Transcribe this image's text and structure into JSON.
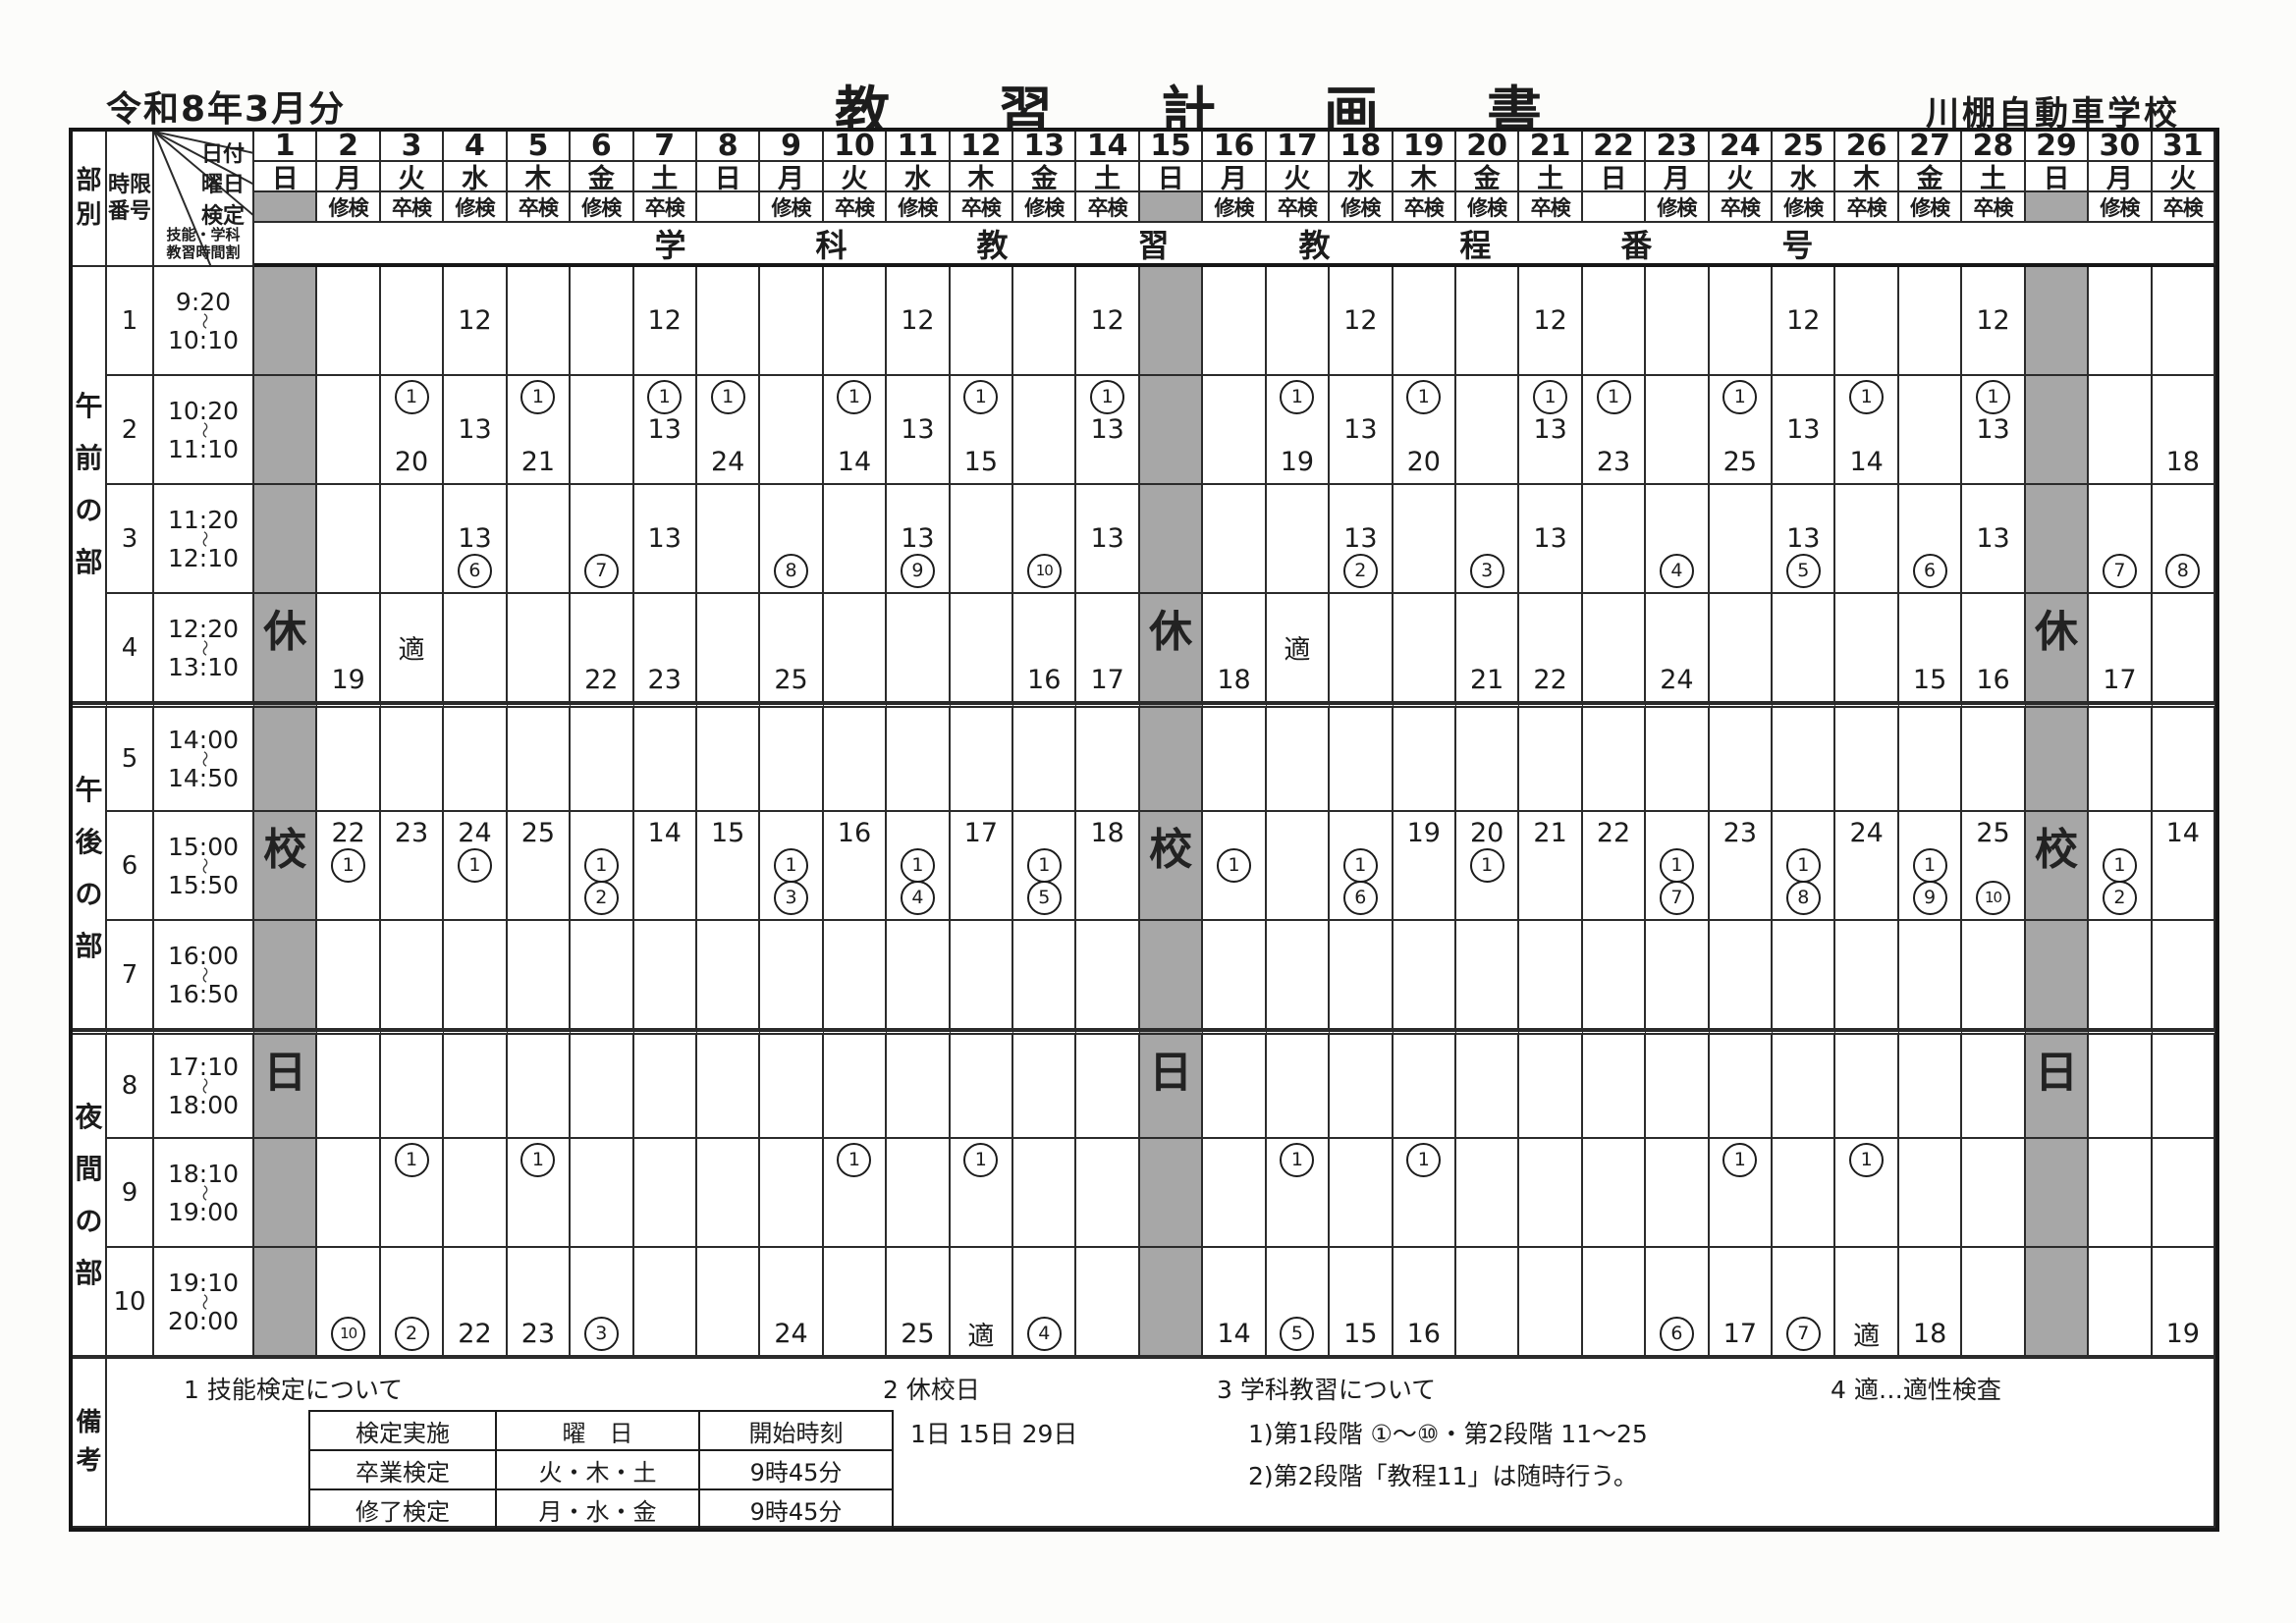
{
  "page": {
    "ink": "#1c1c1c",
    "line": "#2b2b2b",
    "closed_gray": "#a7a7a7",
    "paper": "#fcfcfa"
  },
  "title": {
    "period": "令和8年3月分",
    "main": "教習計画書",
    "school": "川棚自動車学校"
  },
  "corner": {
    "part_label": "部別",
    "period_label_1": "時限",
    "period_label_2": "番号",
    "row_labels": [
      "日付",
      "曜日",
      "検定"
    ],
    "skill_label_1": "技能・学科",
    "skill_label_2": "教習時間割"
  },
  "band_title": "学科教習教程番号",
  "wave": "〜",
  "closed_vertical": "休校日",
  "days": [
    {
      "date": 1,
      "dow": "日",
      "exam": "",
      "closed": true
    },
    {
      "date": 2,
      "dow": "月",
      "exam": "修検",
      "closed": false
    },
    {
      "date": 3,
      "dow": "火",
      "exam": "卒検",
      "closed": false
    },
    {
      "date": 4,
      "dow": "水",
      "exam": "修検",
      "closed": false
    },
    {
      "date": 5,
      "dow": "木",
      "exam": "卒検",
      "closed": false
    },
    {
      "date": 6,
      "dow": "金",
      "exam": "修検",
      "closed": false
    },
    {
      "date": 7,
      "dow": "土",
      "exam": "卒検",
      "closed": false
    },
    {
      "date": 8,
      "dow": "日",
      "exam": "",
      "closed": false
    },
    {
      "date": 9,
      "dow": "月",
      "exam": "修検",
      "closed": false
    },
    {
      "date": 10,
      "dow": "火",
      "exam": "卒検",
      "closed": false
    },
    {
      "date": 11,
      "dow": "水",
      "exam": "修検",
      "closed": false
    },
    {
      "date": 12,
      "dow": "木",
      "exam": "卒検",
      "closed": false
    },
    {
      "date": 13,
      "dow": "金",
      "exam": "修検",
      "closed": false
    },
    {
      "date": 14,
      "dow": "土",
      "exam": "卒検",
      "closed": false
    },
    {
      "date": 15,
      "dow": "日",
      "exam": "",
      "closed": true
    },
    {
      "date": 16,
      "dow": "月",
      "exam": "修検",
      "closed": false
    },
    {
      "date": 17,
      "dow": "火",
      "exam": "卒検",
      "closed": false
    },
    {
      "date": 18,
      "dow": "水",
      "exam": "修検",
      "closed": false
    },
    {
      "date": 19,
      "dow": "木",
      "exam": "卒検",
      "closed": false
    },
    {
      "date": 20,
      "dow": "金",
      "exam": "修検",
      "closed": false
    },
    {
      "date": 21,
      "dow": "土",
      "exam": "卒検",
      "closed": false
    },
    {
      "date": 22,
      "dow": "日",
      "exam": "",
      "closed": false
    },
    {
      "date": 23,
      "dow": "月",
      "exam": "修検",
      "closed": false
    },
    {
      "date": 24,
      "dow": "火",
      "exam": "卒検",
      "closed": false
    },
    {
      "date": 25,
      "dow": "水",
      "exam": "修検",
      "closed": false
    },
    {
      "date": 26,
      "dow": "木",
      "exam": "卒検",
      "closed": false
    },
    {
      "date": 27,
      "dow": "金",
      "exam": "修検",
      "closed": false
    },
    {
      "date": 28,
      "dow": "土",
      "exam": "卒検",
      "closed": false
    },
    {
      "date": 29,
      "dow": "日",
      "exam": "",
      "closed": true
    },
    {
      "date": 30,
      "dow": "月",
      "exam": "修検",
      "closed": false
    },
    {
      "date": 31,
      "dow": "火",
      "exam": "卒検",
      "closed": false
    }
  ],
  "sections": [
    {
      "name": "午前の部",
      "periods": [
        1,
        2,
        3,
        4
      ]
    },
    {
      "name": "午後の部",
      "periods": [
        5,
        6,
        7
      ]
    },
    {
      "name": "夜間の部",
      "periods": [
        8,
        9,
        10
      ]
    }
  ],
  "periods": [
    {
      "no": 1,
      "start": "9:20",
      "end": "10:10",
      "cells": {
        "4": [
          "",
          "12",
          ""
        ],
        "7": [
          "",
          "12",
          ""
        ],
        "11": [
          "",
          "12",
          ""
        ],
        "14": [
          "",
          "12",
          ""
        ],
        "18": [
          "",
          "12",
          ""
        ],
        "21": [
          "",
          "12",
          ""
        ],
        "25": [
          "",
          "12",
          ""
        ],
        "28": [
          "",
          "12",
          ""
        ]
      }
    },
    {
      "no": 2,
      "start": "10:20",
      "end": "11:10",
      "cells": {
        "3": [
          "①",
          "",
          "20"
        ],
        "4": [
          "",
          "13",
          ""
        ],
        "5": [
          "①",
          "",
          "21"
        ],
        "7": [
          "①",
          "13",
          ""
        ],
        "8": [
          "①",
          "",
          "24"
        ],
        "10": [
          "①",
          "",
          "14"
        ],
        "11": [
          "",
          "13",
          ""
        ],
        "12": [
          "①",
          "",
          "15"
        ],
        "14": [
          "①",
          "13",
          ""
        ],
        "17": [
          "①",
          "",
          "19"
        ],
        "18": [
          "",
          "13",
          ""
        ],
        "19": [
          "①",
          "",
          "20"
        ],
        "21": [
          "①",
          "13",
          ""
        ],
        "22": [
          "①",
          "",
          "23"
        ],
        "24": [
          "①",
          "",
          "25"
        ],
        "25": [
          "",
          "13",
          ""
        ],
        "26": [
          "①",
          "",
          "14"
        ],
        "28": [
          "①",
          "13",
          ""
        ],
        "31": [
          "",
          "",
          "18"
        ]
      }
    },
    {
      "no": 3,
      "start": "11:20",
      "end": "12:10",
      "cells": {
        "4": [
          "",
          "13",
          "⑥"
        ],
        "6": [
          "",
          "",
          "⑦"
        ],
        "7": [
          "",
          "13",
          ""
        ],
        "9": [
          "",
          "",
          "⑧"
        ],
        "11": [
          "",
          "13",
          "⑨"
        ],
        "13": [
          "",
          "",
          "⑩"
        ],
        "14": [
          "",
          "13",
          ""
        ],
        "18": [
          "",
          "13",
          "②"
        ],
        "20": [
          "",
          "",
          "③"
        ],
        "21": [
          "",
          "13",
          ""
        ],
        "23": [
          "",
          "",
          "④"
        ],
        "25": [
          "",
          "13",
          "⑤"
        ],
        "27": [
          "",
          "",
          "⑥"
        ],
        "28": [
          "",
          "13",
          ""
        ],
        "30": [
          "",
          "",
          "⑦"
        ],
        "31": [
          "",
          "",
          "⑧"
        ]
      }
    },
    {
      "no": 4,
      "start": "12:20",
      "end": "13:10",
      "cells": {
        "2": [
          "",
          "",
          "19"
        ],
        "3": [
          "",
          "適",
          ""
        ],
        "6": [
          "",
          "",
          "22"
        ],
        "7": [
          "",
          "",
          "23"
        ],
        "9": [
          "",
          "",
          "25"
        ],
        "13": [
          "",
          "",
          "16"
        ],
        "14": [
          "",
          "",
          "17"
        ],
        "16": [
          "",
          "",
          "18"
        ],
        "17": [
          "",
          "適",
          ""
        ],
        "20": [
          "",
          "",
          "21"
        ],
        "21": [
          "",
          "",
          "22"
        ],
        "23": [
          "",
          "",
          "24"
        ],
        "27": [
          "",
          "",
          "15"
        ],
        "28": [
          "",
          "",
          "16"
        ],
        "30": [
          "",
          "",
          "17"
        ]
      }
    },
    {
      "no": 5,
      "start": "14:00",
      "end": "14:50",
      "cells": {}
    },
    {
      "no": 6,
      "start": "15:00",
      "end": "15:50",
      "cells": {
        "2": [
          "22",
          "①",
          ""
        ],
        "3": [
          "23",
          "",
          ""
        ],
        "4": [
          "24",
          "①",
          ""
        ],
        "5": [
          "25",
          "",
          ""
        ],
        "6": [
          "",
          "①",
          "②"
        ],
        "7": [
          "14",
          "",
          ""
        ],
        "8": [
          "15",
          "",
          ""
        ],
        "9": [
          "",
          "①",
          "③"
        ],
        "10": [
          "16",
          "",
          ""
        ],
        "11": [
          "",
          "①",
          "④"
        ],
        "12": [
          "17",
          "",
          ""
        ],
        "13": [
          "",
          "①",
          "⑤"
        ],
        "14": [
          "18",
          "",
          ""
        ],
        "16": [
          "",
          "①",
          ""
        ],
        "18": [
          "",
          "①",
          "⑥"
        ],
        "19": [
          "19",
          "",
          ""
        ],
        "20": [
          "20",
          "①",
          ""
        ],
        "21": [
          "21",
          "",
          ""
        ],
        "22": [
          "22",
          "",
          ""
        ],
        "23": [
          "",
          "①",
          "⑦"
        ],
        "24": [
          "23",
          "",
          ""
        ],
        "25": [
          "",
          "①",
          "⑧"
        ],
        "26": [
          "24",
          "",
          ""
        ],
        "27": [
          "",
          "①",
          "⑨"
        ],
        "28": [
          "25",
          "",
          "⑩"
        ],
        "30": [
          "",
          "①",
          "②"
        ],
        "31": [
          "14",
          "",
          ""
        ]
      }
    },
    {
      "no": 7,
      "start": "16:00",
      "end": "16:50",
      "cells": {}
    },
    {
      "no": 8,
      "start": "17:10",
      "end": "18:00",
      "cells": {}
    },
    {
      "no": 9,
      "start": "18:10",
      "end": "19:00",
      "cells": {
        "3": [
          "①",
          "",
          ""
        ],
        "5": [
          "①",
          "",
          ""
        ],
        "10": [
          "①",
          "",
          ""
        ],
        "12": [
          "①",
          "",
          ""
        ],
        "17": [
          "①",
          "",
          ""
        ],
        "19": [
          "①",
          "",
          ""
        ],
        "24": [
          "①",
          "",
          ""
        ],
        "26": [
          "①",
          "",
          ""
        ]
      }
    },
    {
      "no": 10,
      "start": "19:10",
      "end": "20:00",
      "cells": {
        "2": [
          "",
          "",
          "⑩"
        ],
        "3": [
          "",
          "",
          "②"
        ],
        "4": [
          "",
          "",
          "22"
        ],
        "5": [
          "",
          "",
          "23"
        ],
        "6": [
          "",
          "",
          "③"
        ],
        "9": [
          "",
          "",
          "24"
        ],
        "11": [
          "",
          "",
          "25"
        ],
        "12": [
          "",
          "",
          "適"
        ],
        "13": [
          "",
          "",
          "④"
        ],
        "16": [
          "",
          "",
          "14"
        ],
        "17": [
          "",
          "",
          "⑤"
        ],
        "18": [
          "",
          "",
          "15"
        ],
        "19": [
          "",
          "",
          "16"
        ],
        "23": [
          "",
          "",
          "⑥"
        ],
        "24": [
          "",
          "",
          "17"
        ],
        "25": [
          "",
          "",
          "⑦"
        ],
        "26": [
          "",
          "",
          "適"
        ],
        "27": [
          "",
          "",
          "18"
        ],
        "31": [
          "",
          "",
          "19"
        ]
      }
    }
  ],
  "remarks": {
    "label": "備考",
    "item1_title": "1  技能検定について",
    "exam_table": {
      "headers": [
        "検定実施",
        "曜　日",
        "開始時刻"
      ],
      "rows": [
        [
          "卒業検定",
          "火・木・土",
          "9時45分"
        ],
        [
          "修了検定",
          "月・水・金",
          "9時45分"
        ]
      ]
    },
    "item2_title": "2  休校日",
    "item2_body": "1日  15日  29日",
    "item3_title": "3   学科教習について",
    "item3_line1": "1)第1段階  ①～⑩・第2段階  11～25",
    "item3_line2": "2)第2段階「教程11」は随時行う。",
    "item4_title": "4   適…適性検査"
  }
}
